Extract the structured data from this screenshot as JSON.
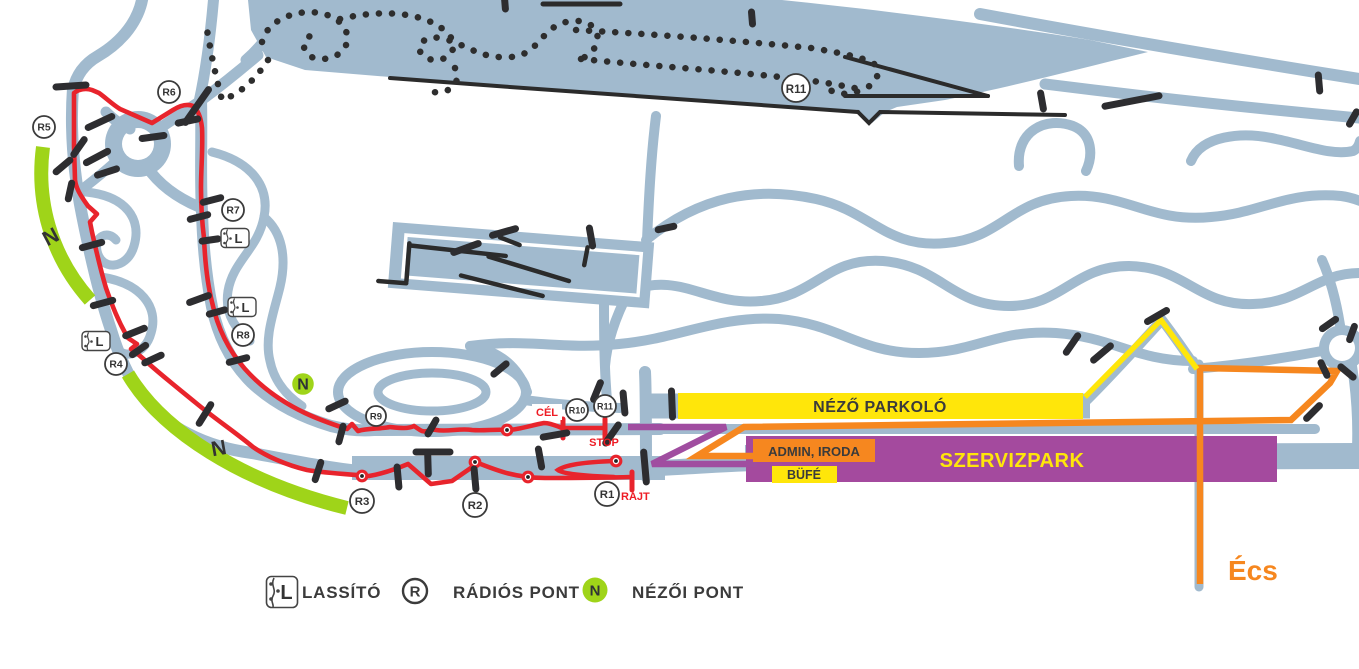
{
  "map": {
    "areas": {
      "nezo_parkolo": "NÉZŐ PARKOLÓ",
      "szervizpark": "SZERVIZPARK",
      "admin_iroda": "ADMIN, IRODA",
      "bufe": "BÜFÉ"
    },
    "course": {
      "start": "RAJT",
      "finish": "CÉL",
      "stop": "STOP"
    },
    "destination": "Écs",
    "spectator_letter": "N",
    "radio_points": [
      {
        "label": "R1",
        "x": 607,
        "y": 494,
        "r": 12
      },
      {
        "label": "R2",
        "x": 475,
        "y": 505,
        "r": 12
      },
      {
        "label": "R3",
        "x": 362,
        "y": 501,
        "r": 12
      },
      {
        "label": "R4",
        "x": 116,
        "y": 364,
        "r": 11
      },
      {
        "label": "R5",
        "x": 44,
        "y": 127,
        "r": 11
      },
      {
        "label": "R6",
        "x": 169,
        "y": 92,
        "r": 11
      },
      {
        "label": "R7",
        "x": 233,
        "y": 210,
        "r": 11
      },
      {
        "label": "R8",
        "x": 243,
        "y": 335,
        "r": 11
      },
      {
        "label": "R9",
        "x": 376,
        "y": 416,
        "r": 10
      },
      {
        "label": "R10",
        "x": 577,
        "y": 410,
        "r": 11
      },
      {
        "label": "R11",
        "x": 605,
        "y": 406,
        "r": 11
      },
      {
        "label": "R11",
        "x": 796,
        "y": 88,
        "r": 14
      }
    ],
    "lassito_points": [
      {
        "x": 235,
        "y": 238
      },
      {
        "x": 242,
        "y": 307
      },
      {
        "x": 96,
        "y": 341
      }
    ],
    "nezoi_points": [
      {
        "x": 303,
        "y": 384
      }
    ],
    "n_zone_labels": [
      {
        "x": 54,
        "y": 243,
        "rotate": -28
      },
      {
        "x": 220,
        "y": 455,
        "rotate": -10
      }
    ],
    "colors": {
      "road": "#a1bace",
      "course_red": "#e8242c",
      "spectator_green": "#9fd419",
      "parking_yellow": "#ffe60a",
      "service_purple": "#a44a9e",
      "admin_orange": "#f6871f",
      "walk_route_purple": "#a04da0",
      "access_route_orange": "#f6871f",
      "access_route_yellow": "#ffe60a",
      "barrier_black": "#2d2d30",
      "text_dark": "#3b3b3b",
      "label_red": "#ee1c25"
    }
  },
  "legend": {
    "items": [
      {
        "icon": "lassito-icon",
        "label": "LASSÍTÓ"
      },
      {
        "icon": "radio-point-icon",
        "label": "RÁDIÓS PONT"
      },
      {
        "icon": "nezoi-point-icon",
        "label": "NÉZŐI PONT"
      }
    ]
  }
}
